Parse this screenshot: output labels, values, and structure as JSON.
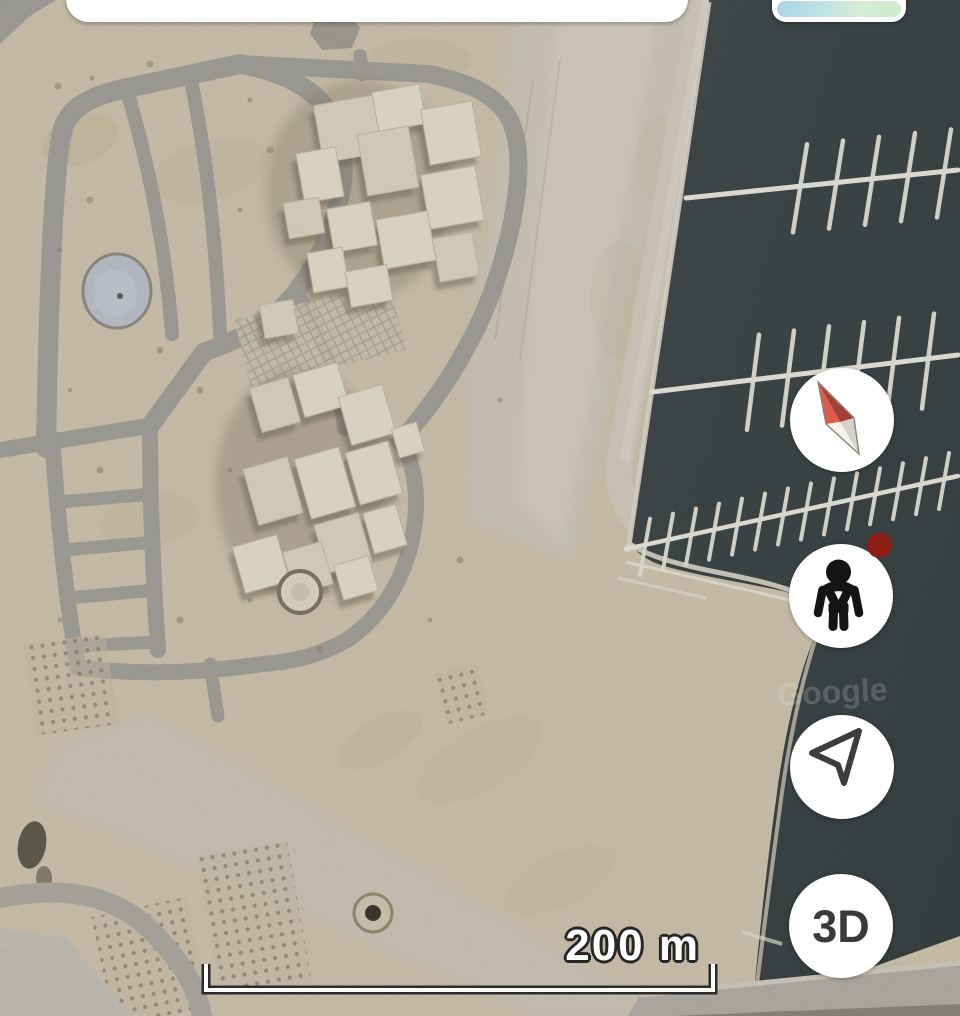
{
  "ui": {
    "search_pill": {
      "visible_text": ""
    },
    "layers_button": {
      "thumbnail": "map-layers-thumbnail"
    },
    "map_controls": [
      {
        "id": "compass",
        "icon": "compass-needle-icon",
        "label": ""
      },
      {
        "id": "street-view",
        "icon": "pegman-icon",
        "label": "",
        "has_badge": true
      },
      {
        "id": "my-location",
        "icon": "location-arrow-icon",
        "label": ""
      },
      {
        "id": "3d-view",
        "icon": "",
        "label": "3D"
      }
    ],
    "scale_bar": {
      "label": "200 m"
    },
    "watermark": "Google"
  },
  "map_view": {
    "type": "satellite",
    "features": [
      "desert construction site",
      "street grid",
      "building clusters",
      "marina with docks",
      "dark water",
      "sand spit",
      "scale bar"
    ]
  },
  "colors": {
    "sand": "#d6cbb4",
    "road_gray": "#a9a6a0",
    "pavement_light": "#d6d0c3",
    "water": "#3e4748",
    "dock_white": "#f1eee4",
    "building_cream": "#ece5d2",
    "compass_red": "#cf5146",
    "badge_red": "#8b1d15",
    "icon_dark": "#3a3a3a",
    "scale_text": "#ffffff",
    "scale_outline": "#262626"
  }
}
